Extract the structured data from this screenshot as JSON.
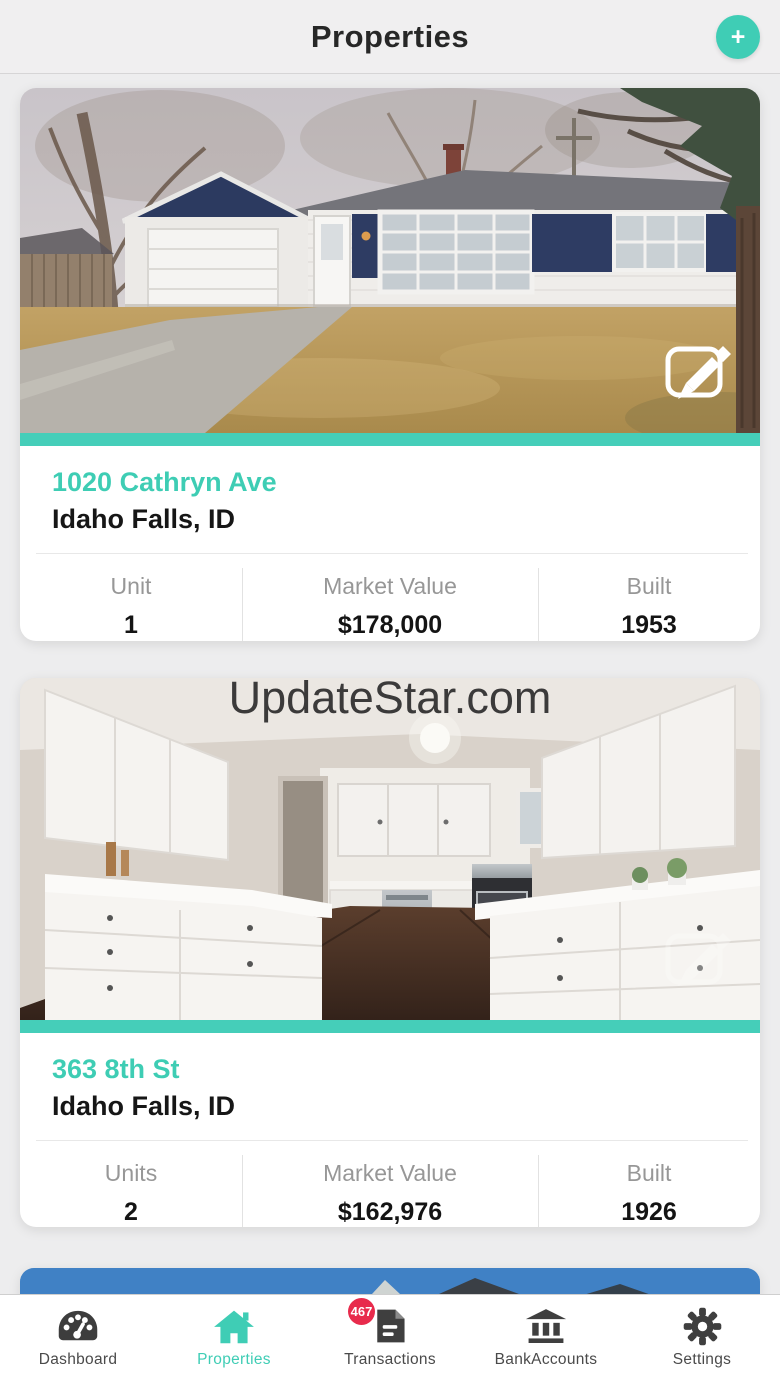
{
  "header": {
    "title": "Properties",
    "add_icon": "+"
  },
  "watermark": "UpdateStar.com",
  "properties": [
    {
      "photo": "house-exterior-front-yard",
      "address": "1020 Cathryn Ave",
      "city": "Idaho Falls, ID",
      "stats": [
        {
          "label": "Unit",
          "value": "1"
        },
        {
          "label": "Market Value",
          "value": "$178,000"
        },
        {
          "label": "Built",
          "value": "1953"
        }
      ]
    },
    {
      "photo": "kitchen-interior",
      "address": "363 8th St",
      "city": "Idaho Falls, ID",
      "stats": [
        {
          "label": "Units",
          "value": "2"
        },
        {
          "label": "Market Value",
          "value": "$162,976"
        },
        {
          "label": "Built",
          "value": "1926"
        }
      ]
    },
    {
      "photo": "exterior-blue-sky-partial"
    }
  ],
  "nav": {
    "items": [
      {
        "label": "Dashboard",
        "icon": "gauge-icon",
        "active": false
      },
      {
        "label": "Properties",
        "icon": "home-icon",
        "active": true
      },
      {
        "label": "Transactions",
        "icon": "receipt-icon",
        "active": false,
        "badge": "467"
      },
      {
        "label": "BankAccounts",
        "icon": "bank-icon",
        "active": false
      },
      {
        "label": "Settings",
        "icon": "gear-icon",
        "active": false
      }
    ]
  },
  "colors": {
    "accent_teal": "#3FCDB5",
    "stripe_teal": "#45CEB9",
    "badge_red": "#E82B4C",
    "sky_blue": "#3E7DC1"
  }
}
